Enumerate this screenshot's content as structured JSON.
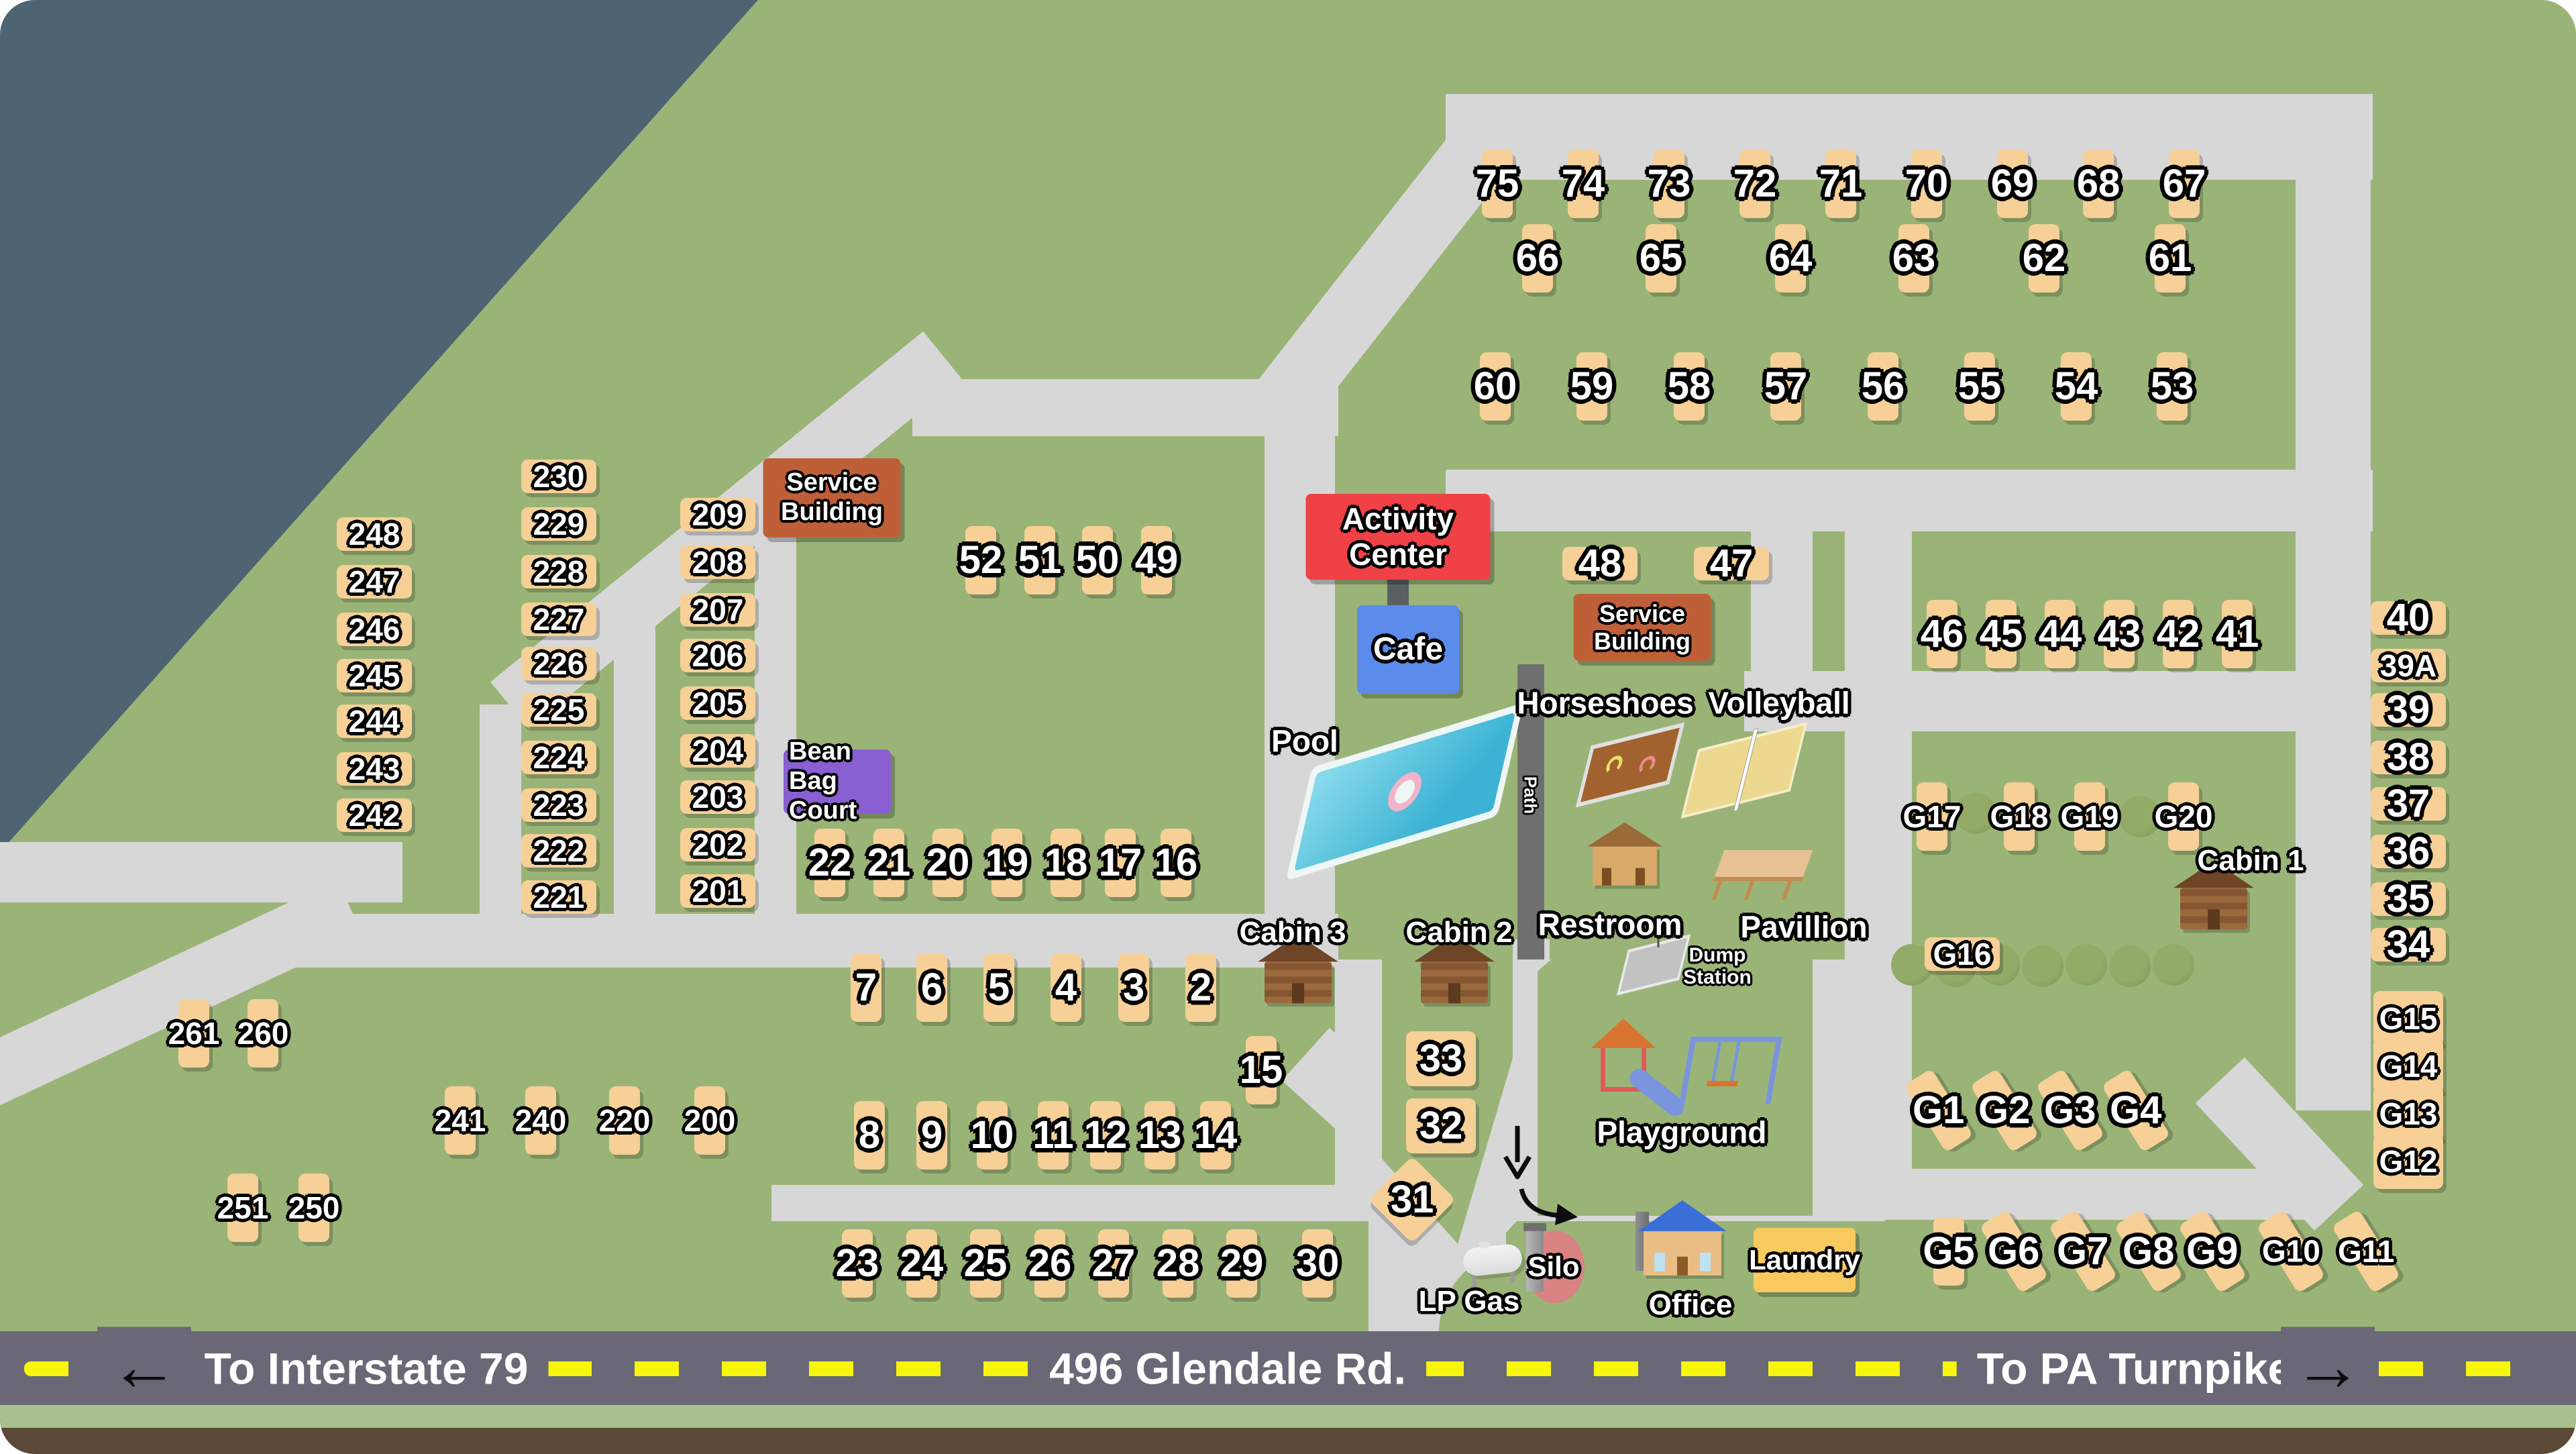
{
  "title": "Campground site map",
  "colors": {
    "background_slate": "#4e6472",
    "grass_green": "#9ab477",
    "road_gray": "#d7d7d7",
    "highway_gray": "#6a6876",
    "dash_yellow": "#f7f50c",
    "site_tan": "#f6d096",
    "service_building_orange": "#bf5f38",
    "activity_center_red": "#ef4146",
    "cafe_blue": "#5b8beb",
    "bean_bag_purple": "#8a5fd1",
    "laundry_yellow": "#f8c95e",
    "pool_teal": "#3cb3d4",
    "bottom_strip_green": "#a9bf8d",
    "bottom_strip_brown": "#5c4837"
  },
  "highway": {
    "left_label": "To Interstate 79",
    "center_label": "496 Glendale Rd.",
    "right_label": "To PA Turnpike",
    "left_arrow": "←",
    "right_arrow": "→"
  },
  "buildings": [
    [
      "service-building-1",
      "Service Building",
      1240,
      742,
      205,
      118,
      "#bf5f38",
      38
    ],
    [
      "service-building-2",
      "Service Building",
      2448,
      935,
      205,
      100,
      "#bf5f38",
      36
    ],
    [
      "activity-center",
      "Activity Center",
      2084,
      800,
      275,
      128,
      "#ef4146",
      46
    ],
    [
      "cafe",
      "Cafe",
      2099,
      968,
      152,
      132,
      "#5b8beb",
      48
    ],
    [
      "bean-bag-court",
      "Bean Bag Court",
      1248,
      1165,
      160,
      96,
      "#8a5fd1",
      38
    ],
    [
      "laundry",
      "Laundry",
      2690,
      1878,
      152,
      96,
      "#f8c95e",
      42
    ]
  ],
  "labels": [
    [
      "pool-label",
      "Pool",
      1945,
      1105,
      46,
      0,
      0
    ],
    [
      "path-label",
      "Path",
      2281,
      1185,
      26,
      90,
      0
    ],
    [
      "horseshoes-label",
      "Horseshoes",
      2393,
      1048,
      46,
      0,
      0
    ],
    [
      "volleyball-label",
      "Volleyball",
      2652,
      1048,
      46,
      0,
      0
    ],
    [
      "restroom-label",
      "Restroom",
      2400,
      1378,
      46,
      0,
      0
    ],
    [
      "pavillion-label",
      "Pavillion",
      2689,
      1382,
      46,
      0,
      0
    ],
    [
      "playground-label",
      "Playground",
      2507,
      1688,
      46,
      0,
      0
    ],
    [
      "dump-station-label",
      "Dump Station",
      2560,
      1440,
      30,
      0,
      160
    ],
    [
      "cabin-3-label",
      "Cabin 3",
      1927,
      1390,
      44,
      0,
      0
    ],
    [
      "cabin-2-label",
      "Cabin 2",
      2175,
      1390,
      44,
      0,
      0
    ],
    [
      "cabin-1-label",
      "Cabin 1",
      3355,
      1283,
      44,
      0,
      0
    ],
    [
      "lp-gas-label",
      "LP Gas",
      2190,
      1940,
      44,
      0,
      0
    ],
    [
      "silo-label",
      "Silo",
      2316,
      1888,
      42,
      0,
      0
    ],
    [
      "office-label",
      "Office",
      2520,
      1945,
      44,
      0,
      0
    ]
  ],
  "sites": [
    [
      "75",
      2232,
      274,
      "v"
    ],
    [
      "74",
      2360,
      274,
      "v"
    ],
    [
      "73",
      2488,
      274,
      "v"
    ],
    [
      "72",
      2616,
      274,
      "v"
    ],
    [
      "71",
      2744,
      274,
      "v"
    ],
    [
      "70",
      2872,
      274,
      "v"
    ],
    [
      "69",
      3000,
      274,
      "v"
    ],
    [
      "68",
      3128,
      274,
      "v"
    ],
    [
      "67",
      3256,
      274,
      "v"
    ],
    [
      "66",
      2292,
      385,
      "v"
    ],
    [
      "65",
      2476,
      385,
      "v"
    ],
    [
      "64",
      2669,
      385,
      "v"
    ],
    [
      "63",
      2853,
      385,
      "v"
    ],
    [
      "62",
      3047,
      385,
      "v"
    ],
    [
      "61",
      3235,
      385,
      "v"
    ],
    [
      "60",
      2229,
      576,
      "v"
    ],
    [
      "59",
      2373,
      576,
      "v"
    ],
    [
      "58",
      2518,
      576,
      "v"
    ],
    [
      "57",
      2662,
      576,
      "v"
    ],
    [
      "56",
      2807,
      576,
      "v"
    ],
    [
      "55",
      2951,
      576,
      "v"
    ],
    [
      "54",
      3095,
      576,
      "v"
    ],
    [
      "53",
      3238,
      576,
      "v"
    ],
    [
      "248",
      558,
      796,
      "h"
    ],
    [
      "247",
      558,
      867,
      "h"
    ],
    [
      "246",
      558,
      938,
      "h"
    ],
    [
      "245",
      558,
      1007,
      "h"
    ],
    [
      "244",
      558,
      1075,
      "h"
    ],
    [
      "243",
      558,
      1146,
      "h"
    ],
    [
      "242",
      558,
      1215,
      "h"
    ],
    [
      "230",
      833,
      710,
      "h"
    ],
    [
      "229",
      833,
      781,
      "h"
    ],
    [
      "228",
      833,
      852,
      "h"
    ],
    [
      "227",
      833,
      923,
      "h"
    ],
    [
      "226",
      833,
      989,
      "h"
    ],
    [
      "225",
      833,
      1058,
      "h"
    ],
    [
      "224",
      833,
      1129,
      "h"
    ],
    [
      "223",
      833,
      1200,
      "h"
    ],
    [
      "222",
      833,
      1268,
      "h"
    ],
    [
      "221",
      833,
      1337,
      "h"
    ],
    [
      "209",
      1070,
      767,
      "h"
    ],
    [
      "208",
      1070,
      838,
      "h"
    ],
    [
      "207",
      1070,
      909,
      "h"
    ],
    [
      "206",
      1070,
      977,
      "h"
    ],
    [
      "205",
      1070,
      1048,
      "h"
    ],
    [
      "204",
      1070,
      1119,
      "h"
    ],
    [
      "203",
      1070,
      1188,
      "h"
    ],
    [
      "202",
      1070,
      1259,
      "h"
    ],
    [
      "201",
      1070,
      1328,
      "h"
    ],
    [
      "52",
      1462,
      835,
      "v"
    ],
    [
      "51",
      1550,
      835,
      "v"
    ],
    [
      "50",
      1636,
      835,
      "v"
    ],
    [
      "49",
      1724,
      835,
      "v"
    ],
    [
      "22",
      1237,
      1286,
      "v"
    ],
    [
      "21",
      1325,
      1286,
      "v"
    ],
    [
      "20",
      1413,
      1286,
      "v"
    ],
    [
      "19",
      1501,
      1286,
      "v"
    ],
    [
      "18",
      1589,
      1286,
      "v"
    ],
    [
      "17",
      1670,
      1286,
      "v"
    ],
    [
      "16",
      1753,
      1286,
      "v"
    ],
    [
      "48",
      2385,
      840,
      "h"
    ],
    [
      "47",
      2581,
      840,
      "h"
    ],
    [
      "46",
      2895,
      945,
      "v"
    ],
    [
      "45",
      2983,
      945,
      "v"
    ],
    [
      "44",
      3071,
      945,
      "v"
    ],
    [
      "43",
      3159,
      945,
      "v"
    ],
    [
      "42",
      3247,
      945,
      "v"
    ],
    [
      "41",
      3335,
      945,
      "v"
    ],
    [
      "40",
      3590,
      921,
      "h"
    ],
    [
      "39A",
      3590,
      992,
      "h"
    ],
    [
      "39",
      3590,
      1058,
      "h"
    ],
    [
      "38",
      3590,
      1129,
      "h"
    ],
    [
      "37",
      3590,
      1198,
      "h"
    ],
    [
      "36",
      3590,
      1269,
      "h"
    ],
    [
      "35",
      3590,
      1340,
      "h"
    ],
    [
      "34",
      3590,
      1408,
      "h"
    ],
    [
      "G17",
      2880,
      1217,
      "v"
    ],
    [
      "G18",
      3010,
      1217,
      "v"
    ],
    [
      "G19",
      3115,
      1217,
      "v"
    ],
    [
      "G20",
      3255,
      1217,
      "v"
    ],
    [
      "G16",
      2925,
      1422,
      "h"
    ],
    [
      "G15",
      3590,
      1518,
      "q"
    ],
    [
      "G14",
      3590,
      1589,
      "q"
    ],
    [
      "G13",
      3590,
      1660,
      "q"
    ],
    [
      "G12",
      3590,
      1731,
      "q"
    ],
    [
      "G1",
      2890,
      1655,
      "s"
    ],
    [
      "G2",
      2988,
      1655,
      "s"
    ],
    [
      "G3",
      3086,
      1655,
      "s"
    ],
    [
      "G4",
      3184,
      1655,
      "s"
    ],
    [
      "G5",
      2905,
      1865,
      "v"
    ],
    [
      "G6",
      3002,
      1865,
      "s"
    ],
    [
      "G7",
      3105,
      1865,
      "s"
    ],
    [
      "G8",
      3203,
      1865,
      "s"
    ],
    [
      "G9",
      3298,
      1865,
      "s"
    ],
    [
      "G10",
      3415,
      1865,
      "s"
    ],
    [
      "G11",
      3527,
      1865,
      "s"
    ],
    [
      "7",
      1291,
      1472,
      "v"
    ],
    [
      "6",
      1389,
      1472,
      "v"
    ],
    [
      "5",
      1489,
      1472,
      "v"
    ],
    [
      "4",
      1589,
      1472,
      "v"
    ],
    [
      "3",
      1690,
      1472,
      "v"
    ],
    [
      "2",
      1790,
      1472,
      "v"
    ],
    [
      "15",
      1880,
      1595,
      "v"
    ],
    [
      "8",
      1296,
      1692,
      "v"
    ],
    [
      "9",
      1389,
      1692,
      "v"
    ],
    [
      "10",
      1479,
      1692,
      "v"
    ],
    [
      "11",
      1570,
      1692,
      "v"
    ],
    [
      "12",
      1648,
      1692,
      "v"
    ],
    [
      "13",
      1729,
      1692,
      "v"
    ],
    [
      "14",
      1812,
      1692,
      "v"
    ],
    [
      "33",
      2148,
      1578,
      "q"
    ],
    [
      "32",
      2148,
      1678,
      "q"
    ],
    [
      "31",
      2105,
      1788,
      "d"
    ],
    [
      "23",
      1278,
      1883,
      "v"
    ],
    [
      "24",
      1374,
      1883,
      "v"
    ],
    [
      "25",
      1469,
      1883,
      "v"
    ],
    [
      "26",
      1565,
      1883,
      "v"
    ],
    [
      "27",
      1660,
      1883,
      "v"
    ],
    [
      "28",
      1756,
      1883,
      "v"
    ],
    [
      "29",
      1851,
      1883,
      "v"
    ],
    [
      "30",
      1964,
      1883,
      "v"
    ],
    [
      "261",
      289,
      1540,
      "v"
    ],
    [
      "260",
      392,
      1540,
      "v"
    ],
    [
      "241",
      686,
      1670,
      "v"
    ],
    [
      "240",
      806,
      1670,
      "v"
    ],
    [
      "220",
      931,
      1670,
      "v"
    ],
    [
      "200",
      1058,
      1670,
      "v"
    ],
    [
      "251",
      362,
      1800,
      "v"
    ],
    [
      "250",
      468,
      1800,
      "v"
    ]
  ],
  "trees": [
    [
      2945,
      1212
    ],
    [
      3190,
      1217
    ],
    [
      2850,
      1438
    ],
    [
      2915,
      1440
    ],
    [
      2980,
      1438
    ],
    [
      3045,
      1440
    ],
    [
      3110,
      1438
    ],
    [
      3175,
      1440
    ],
    [
      3240,
      1438
    ]
  ]
}
